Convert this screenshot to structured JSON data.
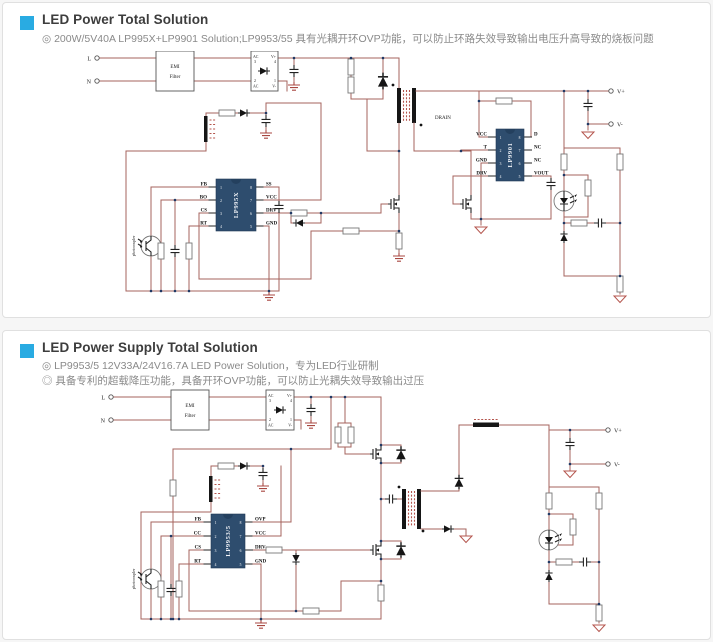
{
  "theme": {
    "bg": "#f6f6f6",
    "panel_bg": "#ffffff",
    "panel_border": "#e0e0e0",
    "accent": "#29abe2",
    "wire": "#a5635c",
    "ic": "#2e4d6e",
    "title_color": "#3d3d3d",
    "bullet_color": "#8a8a8a"
  },
  "panel1": {
    "title": "LED Power Total Solution",
    "bullet1": "◎ 200W/5V40A LP995X+LP9901 Solution;LP9953/55 具有光耦开环OVP功能，可以防止环路失效导致输出电压升高导致的烧板问题",
    "labels": {
      "l": "L",
      "n": "N",
      "emi1": "EMI",
      "emi2": "Filter",
      "drain": "DRAIN",
      "photocoupler": "photocoupler",
      "vplus": "V+",
      "vminus": "V-",
      "bridge": {
        "tl1": "AC",
        "tl2": "3",
        "tr1": "V+",
        "tr2": "4",
        "bl1": "2",
        "bl2": "AC",
        "br1": "1",
        "br2": "V-"
      }
    },
    "ic1": {
      "name": "LP995X",
      "pins_left": [
        "FB",
        "BO",
        "CS",
        "RT"
      ],
      "nums_left": [
        "1",
        "2",
        "3",
        "4"
      ],
      "pins_right": [
        "SS",
        "VCC",
        "DRV",
        "GND"
      ],
      "nums_right": [
        "8",
        "7",
        "6",
        "5"
      ]
    },
    "ic2": {
      "name": "LP9901",
      "pins_left": [
        "VCC",
        "T",
        "GND",
        "DRV"
      ],
      "nums_left": [
        "1",
        "2",
        "3",
        "4"
      ],
      "pins_right": [
        "D",
        "NC",
        "NC",
        "VOUT"
      ],
      "nums_right": [
        "8",
        "7",
        "6",
        "5"
      ]
    }
  },
  "panel2": {
    "title": "LED Power Supply Total Solution",
    "bullet1": "◎ LP9953/5 12V33A/24V16.7A LED Power Solution，专为LED行业研制",
    "bullet2": "◎ 具备专利的超载降压功能，具备开环OVP功能，可以防止光耦失效导致输出过压",
    "labels": {
      "l": "L",
      "n": "N",
      "emi1": "EMI",
      "emi2": "Filter",
      "photocoupler": "photocoupler",
      "vplus": "V+",
      "vminus": "V-",
      "bridge": {
        "tl1": "AC",
        "tl2": "3",
        "tr1": "V+",
        "tr2": "4",
        "bl1": "2",
        "bl2": "AC",
        "br1": "1",
        "br2": "V-"
      }
    },
    "ic1": {
      "name": "LP9953/5",
      "pins_left": [
        "FB",
        "CC",
        "CS",
        "RT"
      ],
      "nums_left": [
        "1",
        "2",
        "3",
        "4"
      ],
      "pins_right": [
        "OVP",
        "VCC",
        "DRV",
        "GND"
      ],
      "nums_right": [
        "8",
        "7",
        "6",
        "5"
      ]
    }
  }
}
